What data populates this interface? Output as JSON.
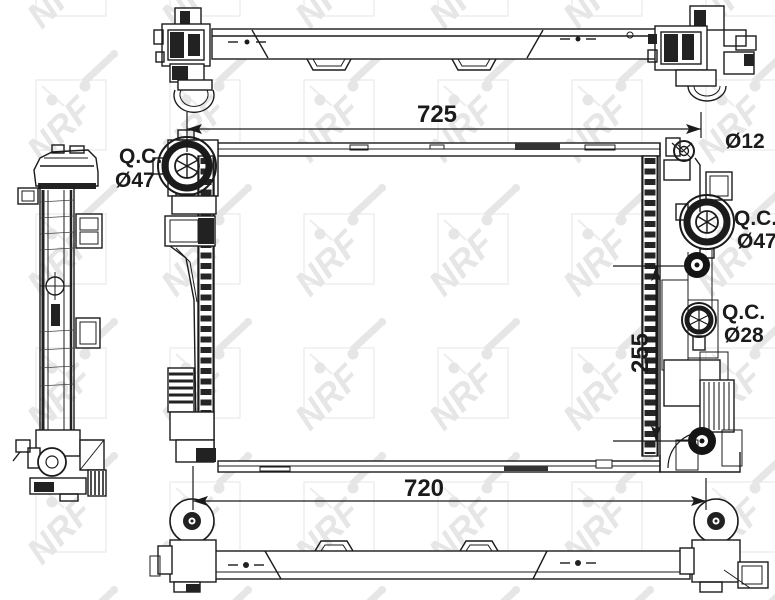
{
  "meta": {
    "drawing_type": "radiator technical drawing",
    "views": [
      "top-view",
      "side-view",
      "front-view",
      "bottom-view"
    ]
  },
  "watermark": {
    "text": "NRF",
    "color": "#e6e6e6"
  },
  "dimensions": {
    "top_width": {
      "value": "725"
    },
    "bottom_width": {
      "value": "720"
    },
    "port_spacing": {
      "value": "255"
    },
    "mount_hole": {
      "value": "Ø12"
    }
  },
  "ports": {
    "left_qc": {
      "label": "Q.C.",
      "size": "Ø47"
    },
    "right_qc_upper": {
      "label": "Q.C.",
      "size": "Ø47"
    },
    "right_qc_lower": {
      "label": "Q.C.",
      "size": "Ø28"
    }
  },
  "colors": {
    "line": "#1b1b1b",
    "background": "#ffffff",
    "watermark": "#e6e6e6",
    "port_fill": "#141414"
  }
}
